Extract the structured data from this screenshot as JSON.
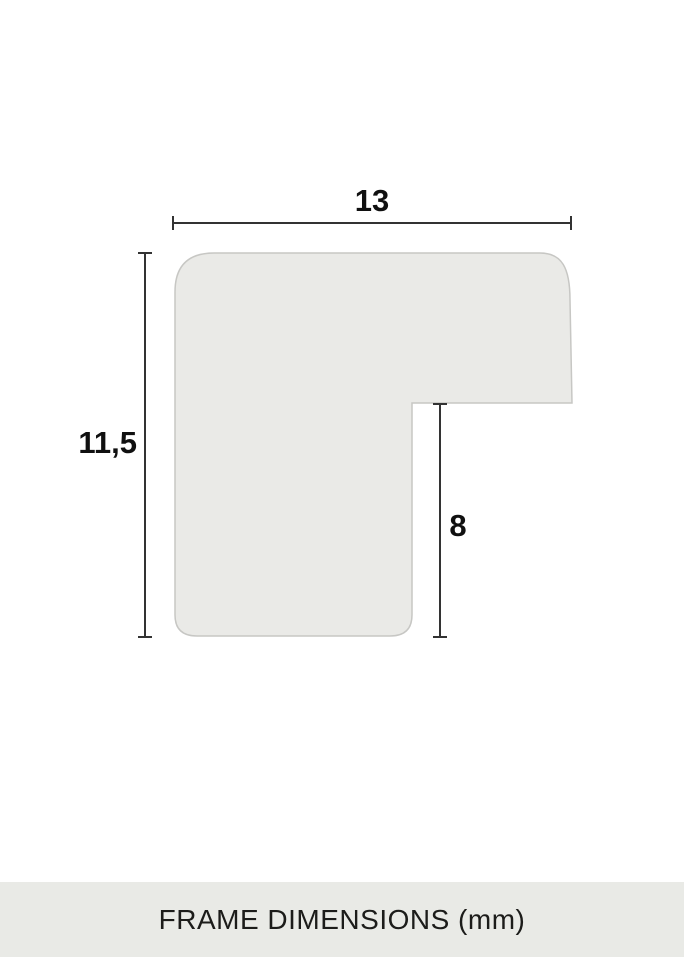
{
  "diagram": {
    "type": "frame-profile-cross-section",
    "dimensions": {
      "width": {
        "label": "13",
        "value": 13
      },
      "height": {
        "label": "11,5",
        "value": 11.5
      },
      "rabbet": {
        "label": "8",
        "value": 8
      }
    }
  },
  "footer": {
    "caption": "FRAME DIMENSIONS (mm)"
  },
  "colors": {
    "background": "#ffffff",
    "shape_fill": "#eaeae7",
    "shape_stroke": "#c7c7c4",
    "dimension_line": "#333333",
    "dimension_text": "#101010",
    "footer_background": "#e9eae6",
    "footer_text": "#1c1c1a"
  }
}
